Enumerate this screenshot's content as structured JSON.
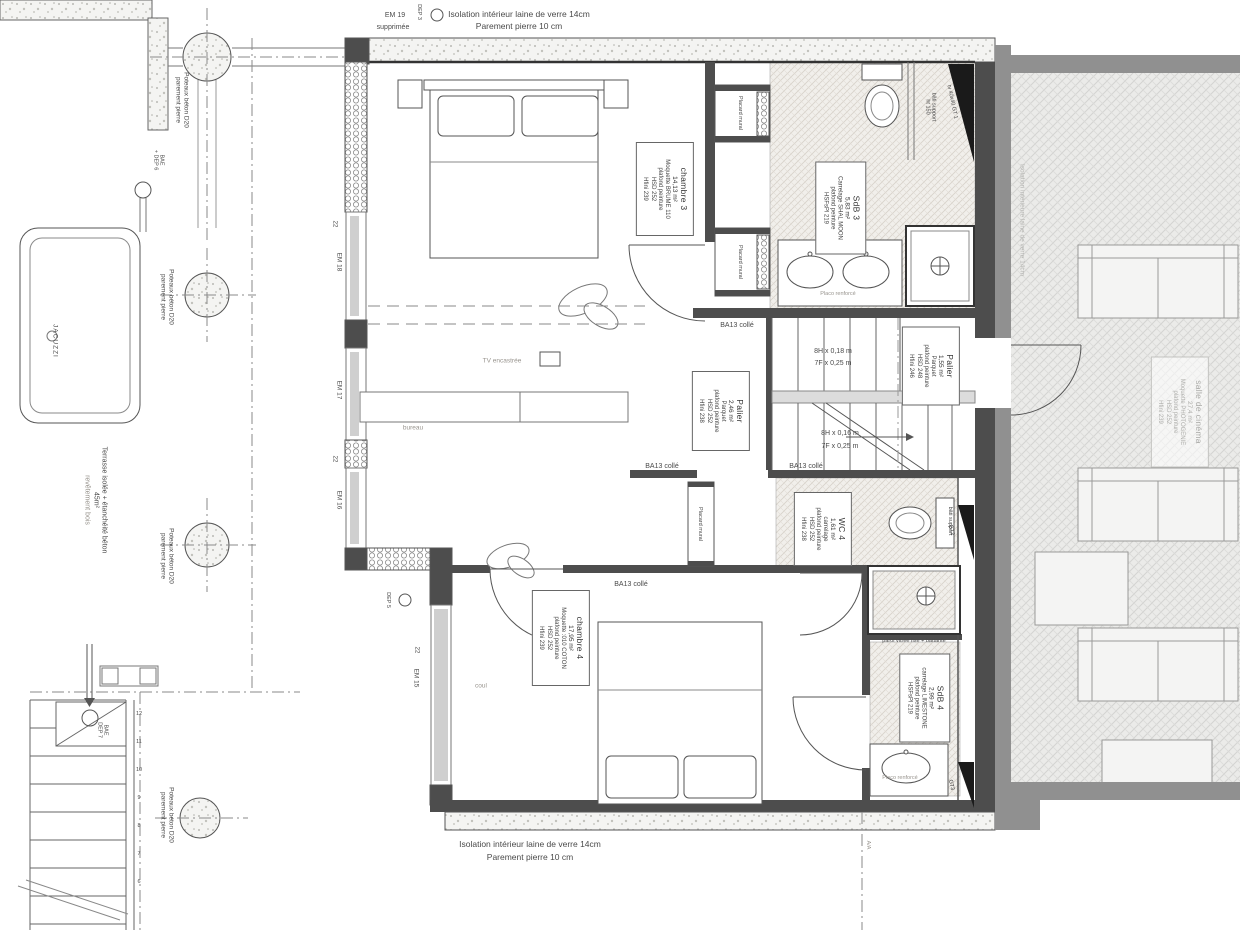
{
  "notes": {
    "top_line1": "Isolation intérieur laine de verre 14cm",
    "top_line2": "Parement pierre 10 cm",
    "bottom_line1": "Isolation intérieur laine de verre 14cm",
    "bottom_line2": "Parement pierre 10 cm",
    "em19_l1": "EM 19",
    "em19_l2": "supprimée",
    "dep3": "DEP 3",
    "dep5": "DEP 5",
    "bae6_l1": "BAE",
    "bae6_l2": "+ DEP 6",
    "bae7_l1": "BAE",
    "bae7_l2": "DEP 7",
    "ba13": "BA13 collé",
    "placo": "Placo renforcé",
    "placard": "Placard mural",
    "paroi": "paroi vitrée fixe + battante",
    "tv_niche": "tv 40x40 GT 1",
    "bati_ht_l1": "bâti support",
    "bati_ht_l2": "ht 150",
    "bati": "bâti support",
    "gt2": "GT2",
    "gt3": "GT3",
    "aa": "A/A",
    "dim22": "22",
    "tv": "TV encastrée",
    "bureau": "bureau",
    "coul": "coul",
    "jacuzzi": "JACUZZI",
    "iso_right": "Isolation intérieure laine de verre 14cm",
    "poteaux_l1": "Poteaux béton D20",
    "poteaux_l2": "parement pierre",
    "terrasse_l1": "Terrasse isolée + étanchéité béton",
    "terrasse_l2": "45m²",
    "terrasse_l3": "revêtement bois"
  },
  "windows": {
    "em15": "EM 15",
    "em16": "EM 16",
    "em17": "EM 17",
    "em18": "EM 18"
  },
  "stairs": {
    "upper_l1": "8H x 0,18 m",
    "upper_l2": "7F x 0,25 m",
    "lower_l1": "8H x 0,16 m",
    "lower_l2": "7F x 0,25 m",
    "step_numbers": [
      "12",
      "11",
      "10",
      "9",
      "8",
      "7",
      "6"
    ]
  },
  "rooms": {
    "chambre3": {
      "name": "chambre 3",
      "area": "14,13 m²",
      "l1": "Moquette BRUME 110",
      "l2": "plafond peinture",
      "l3": "HSD 252",
      "l4": "Hfini 239"
    },
    "sdb3": {
      "name": "SdB 3",
      "area": "5,83 m²",
      "l1": "Carrelage SHAL MOON",
      "l2": "plafond peinture",
      "l3": "HSFsPl 219"
    },
    "palier1": {
      "name": "Palier",
      "area": "2,46 m²",
      "l1": "Parquet",
      "l2": "plafond peinture",
      "l3": "HSD 252",
      "l4": "Hfini 238"
    },
    "palier2": {
      "name": "Palier",
      "area": "1,55 m²",
      "l1": "Parquet",
      "l2": "plafond peinture",
      "l3": "HSD 248",
      "l4": "Hfini 246"
    },
    "wc4": {
      "name": "WC 4",
      "area": "1,61 m²",
      "l1": "carrelage",
      "l2": "plafond peinture",
      "l3": "HSD 252",
      "l4": "Hfini 238"
    },
    "chambre4": {
      "name": "chambre 4",
      "area": "17,95 m²",
      "l1": "Moquette :010 COTON",
      "l2": "plafond peinture",
      "l3": "HSD 252",
      "l4": "Hfini 239"
    },
    "sdb4": {
      "name": "SdB 4",
      "area": "2,99 m²",
      "l1": "carrelage LIMESTONE",
      "l2": "plafond peinture",
      "l3": "HSFsPl 219"
    },
    "cinema": {
      "name": "salle de cinéma",
      "area": "27,4 m²",
      "l1": "Moquette PHOTOGENIE",
      "l2": "plafond peinture",
      "l3": "HSD 252",
      "l4": "Hfini 239"
    }
  },
  "colors": {
    "wall_dark": "#4d4d4d",
    "wall_gray": "#909090",
    "line": "#555555"
  }
}
